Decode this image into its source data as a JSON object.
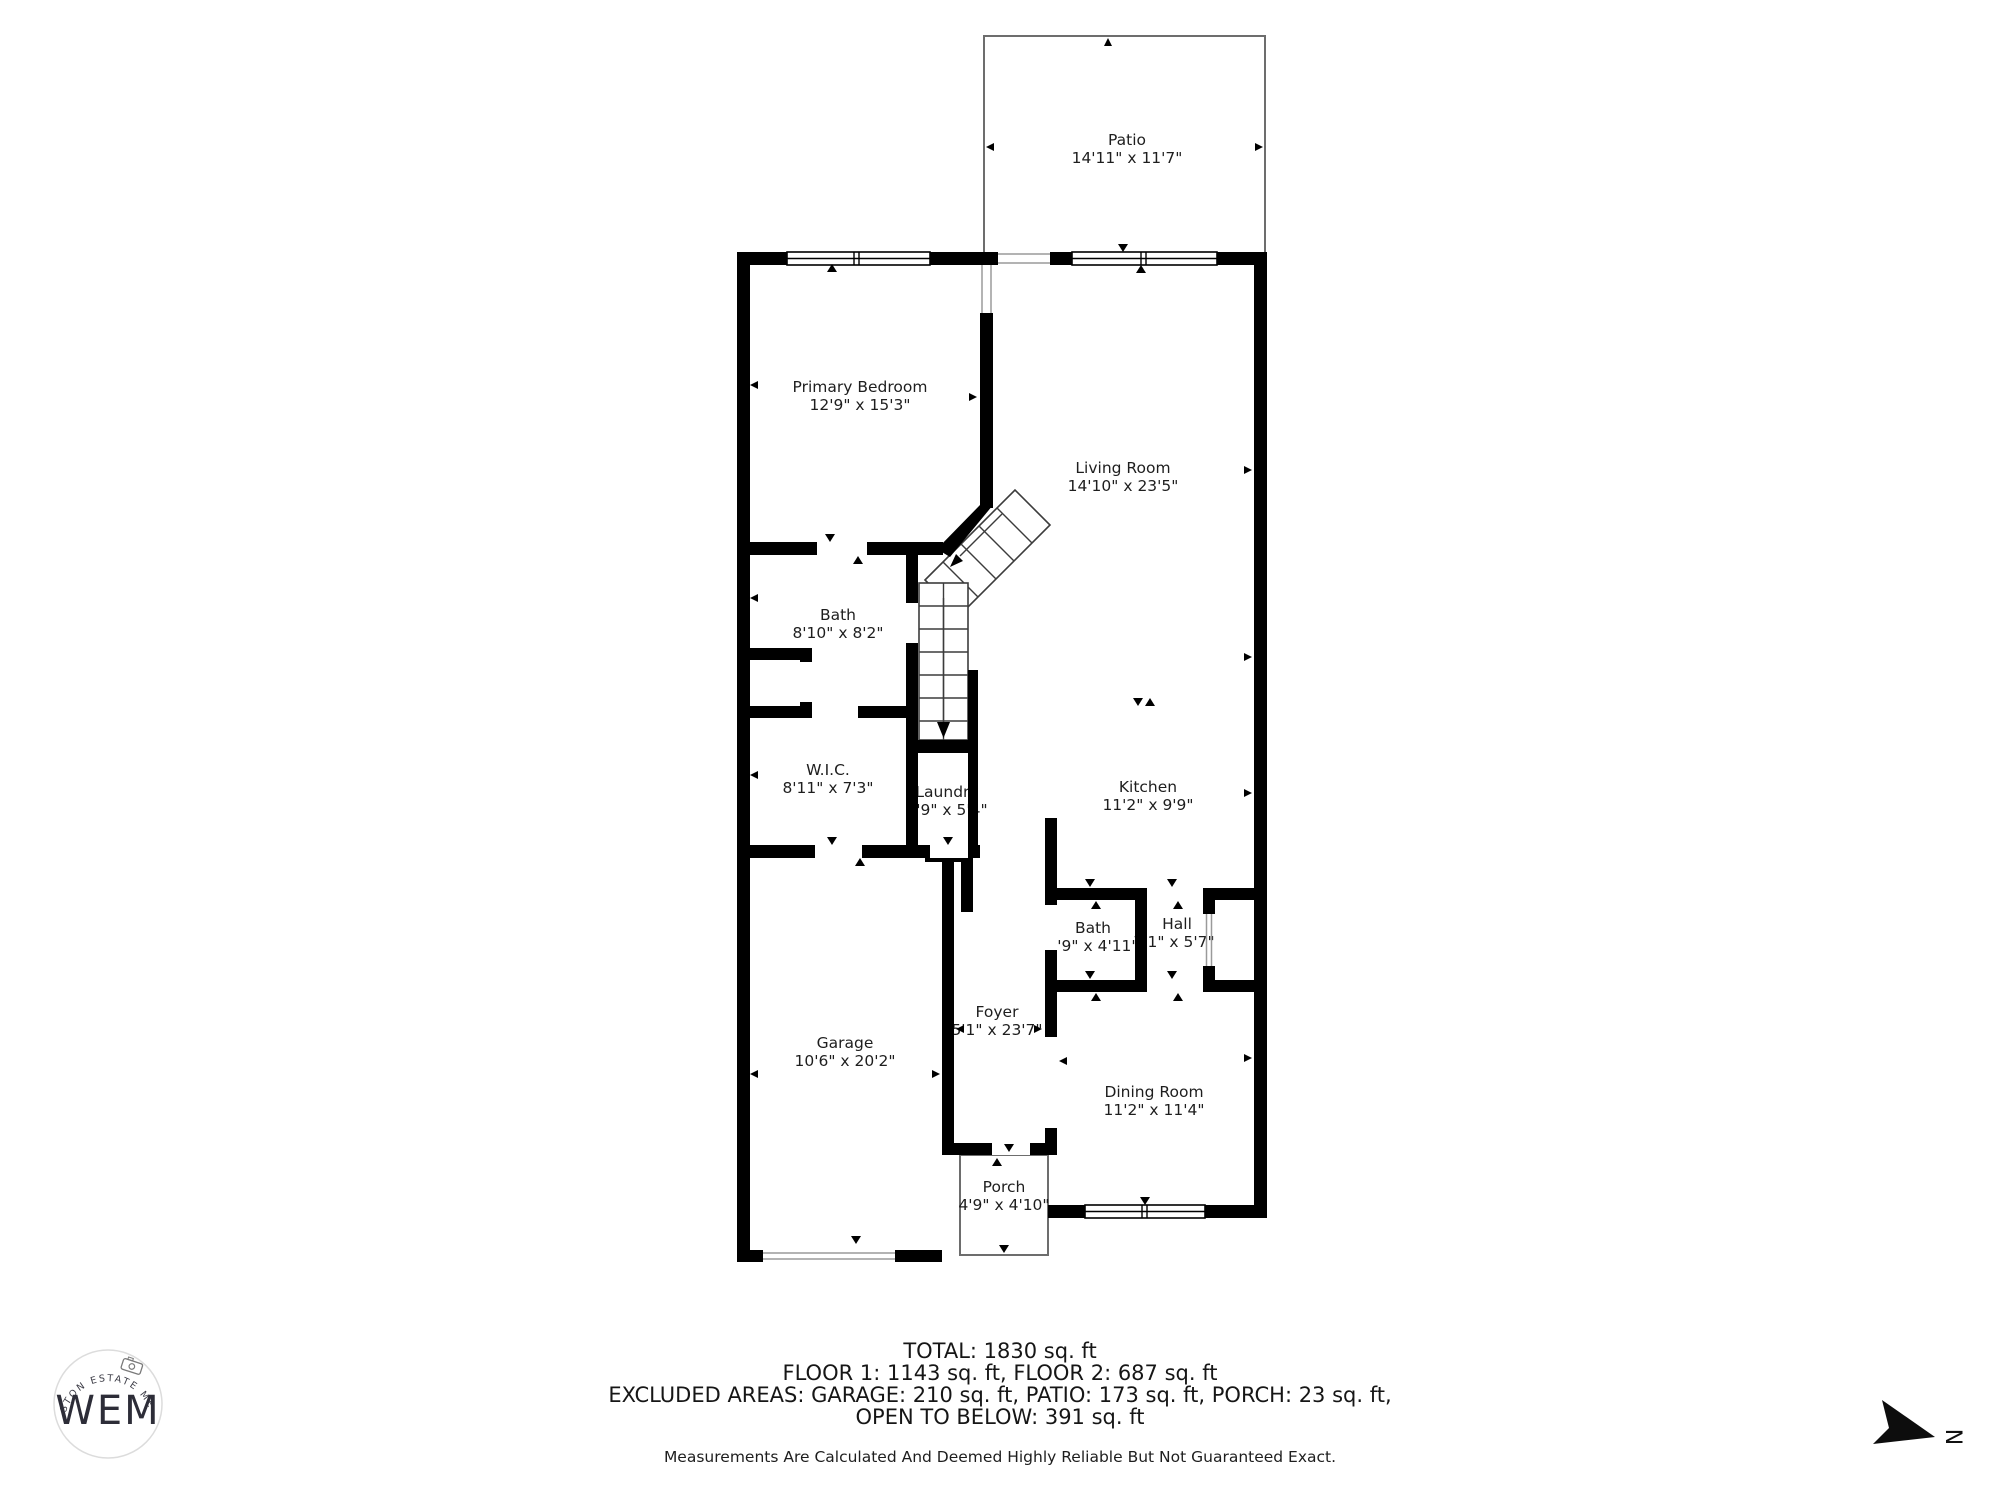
{
  "rooms": {
    "patio": {
      "name": "Patio",
      "dims": "14'11\" x 11'7\""
    },
    "primary_bedroom": {
      "name": "Primary Bedroom",
      "dims": "12'9\" x 15'3\""
    },
    "living_room": {
      "name": "Living Room",
      "dims": "14'10\" x 23'5\""
    },
    "bath_upper": {
      "name": "Bath",
      "dims": "8'10\" x 8'2\""
    },
    "wic": {
      "name": "W.I.C.",
      "dims": "8'11\" x 7'3\""
    },
    "laundry": {
      "name": "Laundry",
      "dims": "2'9\" x 5'4\""
    },
    "kitchen": {
      "name": "Kitchen",
      "dims": "11'2\" x 9'9\""
    },
    "bath_main": {
      "name": "Bath",
      "dims": "4'9\" x 4'11\""
    },
    "hall": {
      "name": "Hall",
      "dims": "7'1\" x 5'7\""
    },
    "foyer": {
      "name": "Foyer",
      "dims": "5'1\" x 23'7\""
    },
    "garage": {
      "name": "Garage",
      "dims": "10'6\" x 20'2\""
    },
    "dining_room": {
      "name": "Dining Room",
      "dims": "11'2\" x 11'4\""
    },
    "porch": {
      "name": "Porch",
      "dims": "4'9\" x 4'10\""
    }
  },
  "summary": {
    "total": "TOTAL: 1830 sq. ft",
    "floors": "FLOOR 1: 1143 sq. ft, FLOOR 2: 687 sq. ft",
    "excluded": "EXCLUDED AREAS: GARAGE: 210 sq. ft, PATIO: 173 sq. ft, PORCH: 23 sq. ft,",
    "open_below": "OPEN TO BELOW: 391 sq. ft",
    "disclaimer": "Measurements Are Calculated And Deemed Highly Reliable But Not Guaranteed Exact."
  },
  "branding": {
    "logo_initials": "WEM",
    "logo_arc_text": "WESTON ESTATE MEDIA"
  },
  "compass": {
    "north_label": "N"
  },
  "colors": {
    "wall": "#000000",
    "outline": "#6d6d6d",
    "text": "#1e1e1e"
  }
}
